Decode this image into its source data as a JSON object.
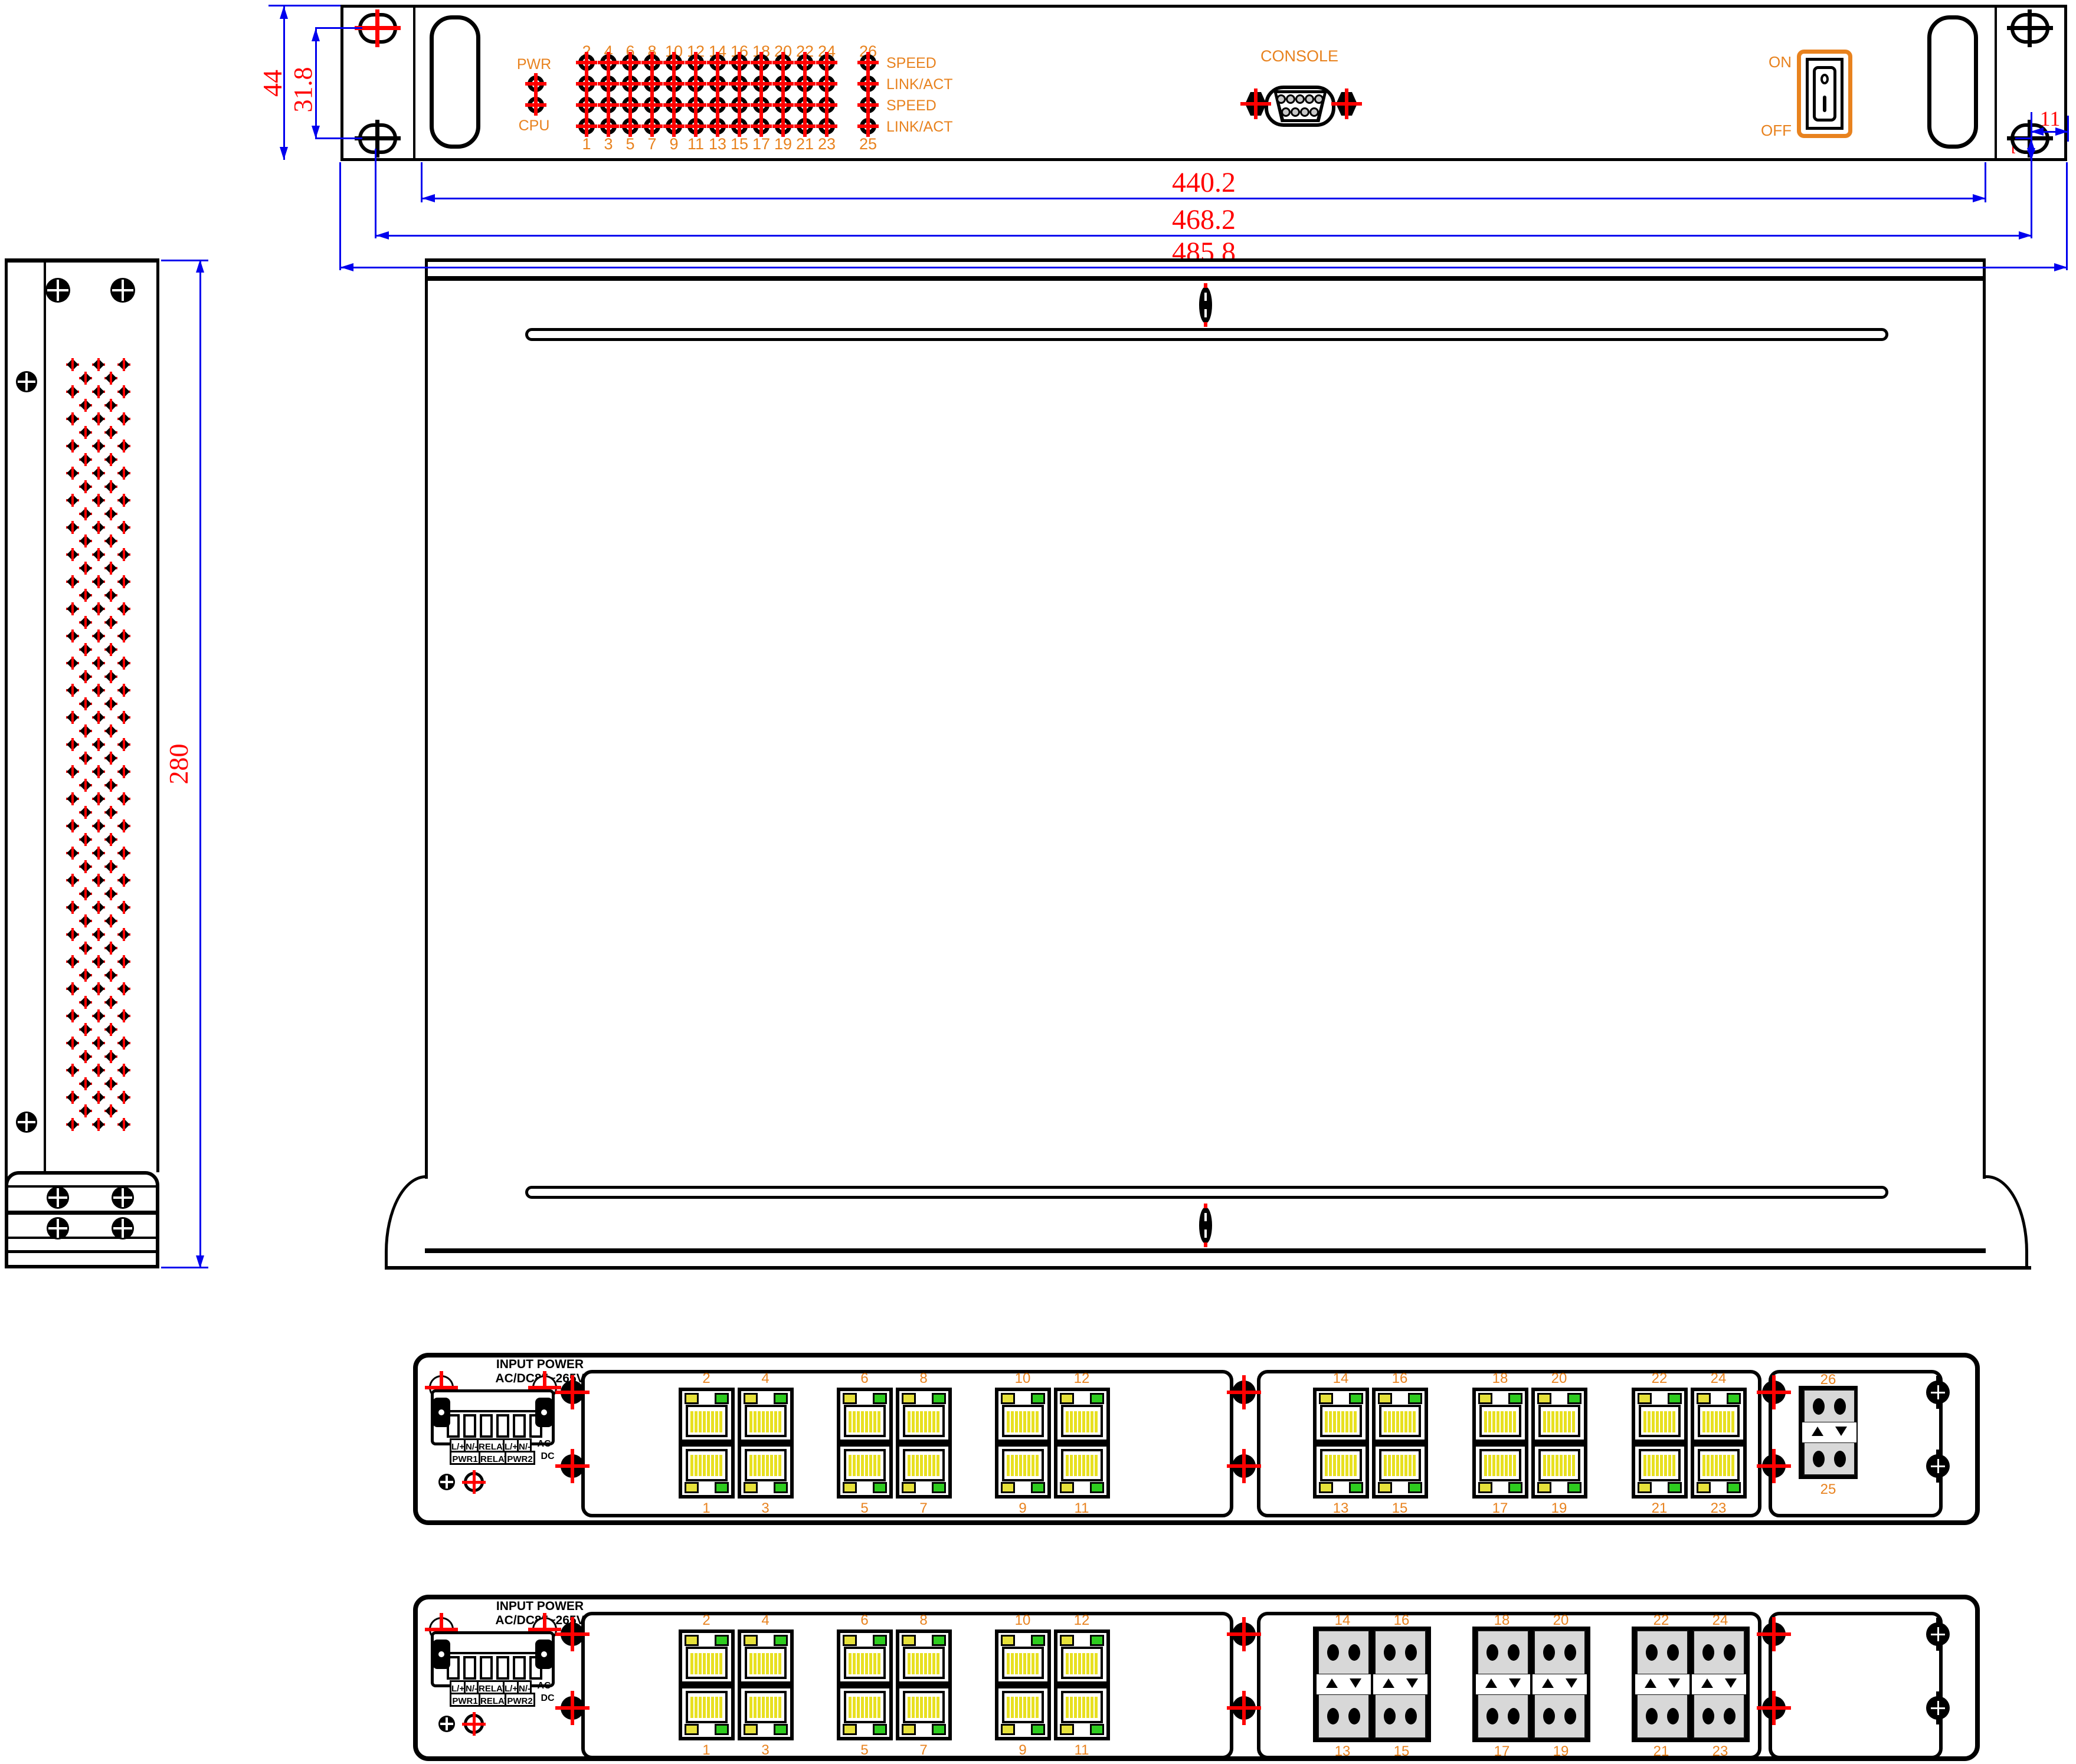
{
  "colors": {
    "outline": "#000000",
    "label_orange": "#E8821E",
    "dimension_red": "#FF0000",
    "dimension_blue": "#0000EE",
    "led_yellow": "#E6E13A",
    "led_green": "#2ECC1F",
    "fiber_gray": "#D8D8D8"
  },
  "front_view": {
    "pwr_label": "PWR",
    "cpu_label": "CPU",
    "even_ports": [
      "2",
      "4",
      "6",
      "8",
      "10",
      "12",
      "14",
      "16",
      "18",
      "20",
      "22",
      "24"
    ],
    "odd_ports": [
      "1",
      "3",
      "5",
      "7",
      "9",
      "11",
      "13",
      "15",
      "17",
      "19",
      "21",
      "23"
    ],
    "port26": "26",
    "port25": "25",
    "led_row_labels": [
      "SPEED",
      "LINK/ACT",
      "SPEED",
      "LINK/ACT"
    ],
    "console_label": "CONSOLE",
    "switch_on": "ON",
    "switch_off": "OFF"
  },
  "dimensions": {
    "panel_height": "44",
    "bracket_hole_spacing": "31.8",
    "body_width": "440.2",
    "mounting_span": "468.2",
    "overall_width": "485.8",
    "side_depth": "280",
    "hole_width": "11",
    "hole_offset": "7"
  },
  "power_block": {
    "line1": "INPUT POWER",
    "line2": "AC/DC85~265V",
    "row1_cells": [
      "L/+",
      "N/-",
      "RELAY",
      "L/+",
      "N/-"
    ],
    "row1_suffix": "AC",
    "row2_cells": [
      "PWR1",
      "RELAY",
      "PWR2"
    ],
    "row2_suffix": "DC"
  },
  "rear_panel_top": {
    "rj45_groups": [
      {
        "top": [
          "2",
          "4"
        ],
        "bottom": [
          "1",
          "3"
        ]
      },
      {
        "top": [
          "6",
          "8"
        ],
        "bottom": [
          "5",
          "7"
        ]
      },
      {
        "top": [
          "10",
          "12"
        ],
        "bottom": [
          "9",
          "11"
        ]
      },
      {
        "top": [
          "14",
          "16"
        ],
        "bottom": [
          "13",
          "15"
        ]
      },
      {
        "top": [
          "18",
          "20"
        ],
        "bottom": [
          "17",
          "19"
        ]
      },
      {
        "top": [
          "22",
          "24"
        ],
        "bottom": [
          "21",
          "23"
        ]
      }
    ],
    "fiber_top": "26",
    "fiber_bottom": "25"
  },
  "rear_panel_bottom": {
    "rj45_groups": [
      {
        "top": [
          "2",
          "4"
        ],
        "bottom": [
          "1",
          "3"
        ]
      },
      {
        "top": [
          "6",
          "8"
        ],
        "bottom": [
          "5",
          "7"
        ]
      },
      {
        "top": [
          "10",
          "12"
        ],
        "bottom": [
          "9",
          "11"
        ]
      }
    ],
    "fiber_groups": [
      {
        "top": [
          "14",
          "16"
        ],
        "bottom": [
          "13",
          "15"
        ]
      },
      {
        "top": [
          "18",
          "20"
        ],
        "bottom": [
          "17",
          "19"
        ]
      },
      {
        "top": [
          "22",
          "24"
        ],
        "bottom": [
          "21",
          "23"
        ]
      }
    ]
  }
}
